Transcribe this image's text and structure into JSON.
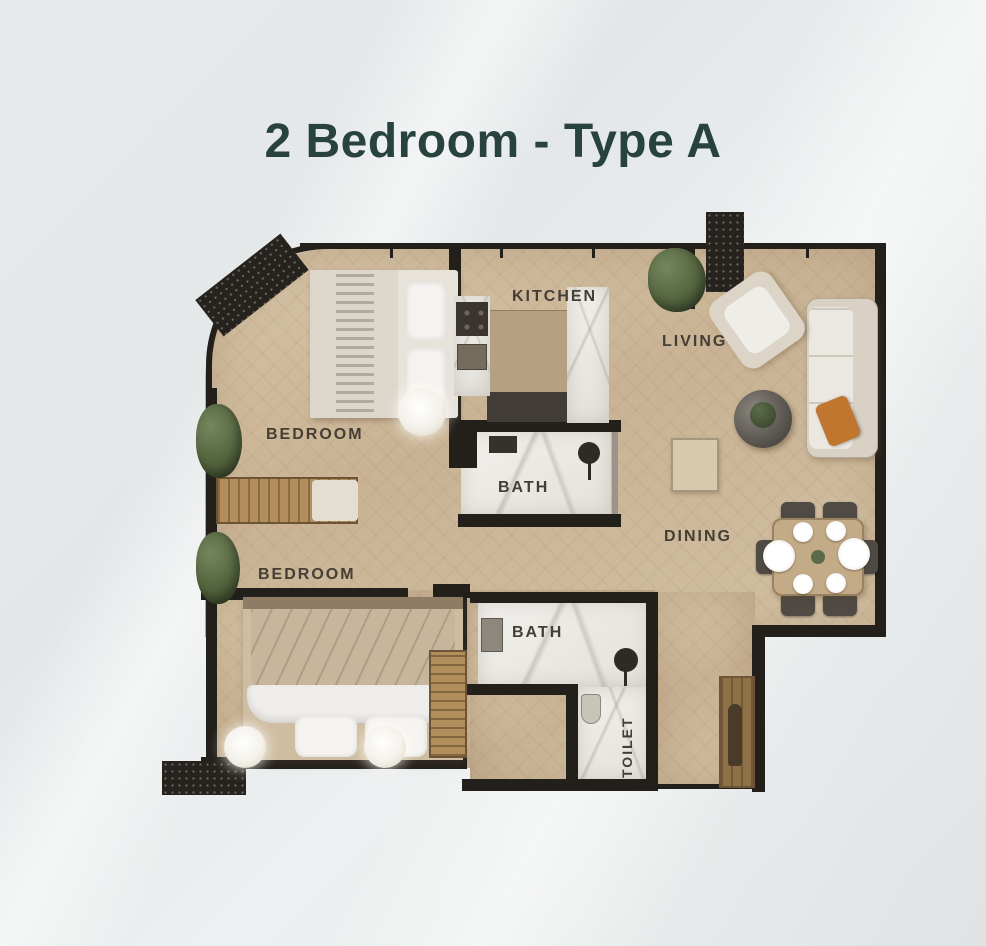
{
  "title": "2 Bedroom - Type A",
  "colors": {
    "title_text": "#28423d",
    "wall": "#23201c",
    "floor_wood": "#cdb89a",
    "bath_marble": "#edebe7",
    "accent_pillow_orange": "#c0762f",
    "plant_green": "#55663f",
    "background": "#e7eaea"
  },
  "floor_plan": {
    "rooms": [
      {
        "id": "bedroom-1",
        "label": "BEDROOM"
      },
      {
        "id": "kitchen",
        "label": "KITCHEN"
      },
      {
        "id": "living",
        "label": "LIVING"
      },
      {
        "id": "bath-1",
        "label": "BATH"
      },
      {
        "id": "bedroom-2",
        "label": "BEDROOM"
      },
      {
        "id": "dining",
        "label": "DINING"
      },
      {
        "id": "bath-2",
        "label": "BATH"
      },
      {
        "id": "toilet",
        "label": "TOILET"
      }
    ]
  }
}
